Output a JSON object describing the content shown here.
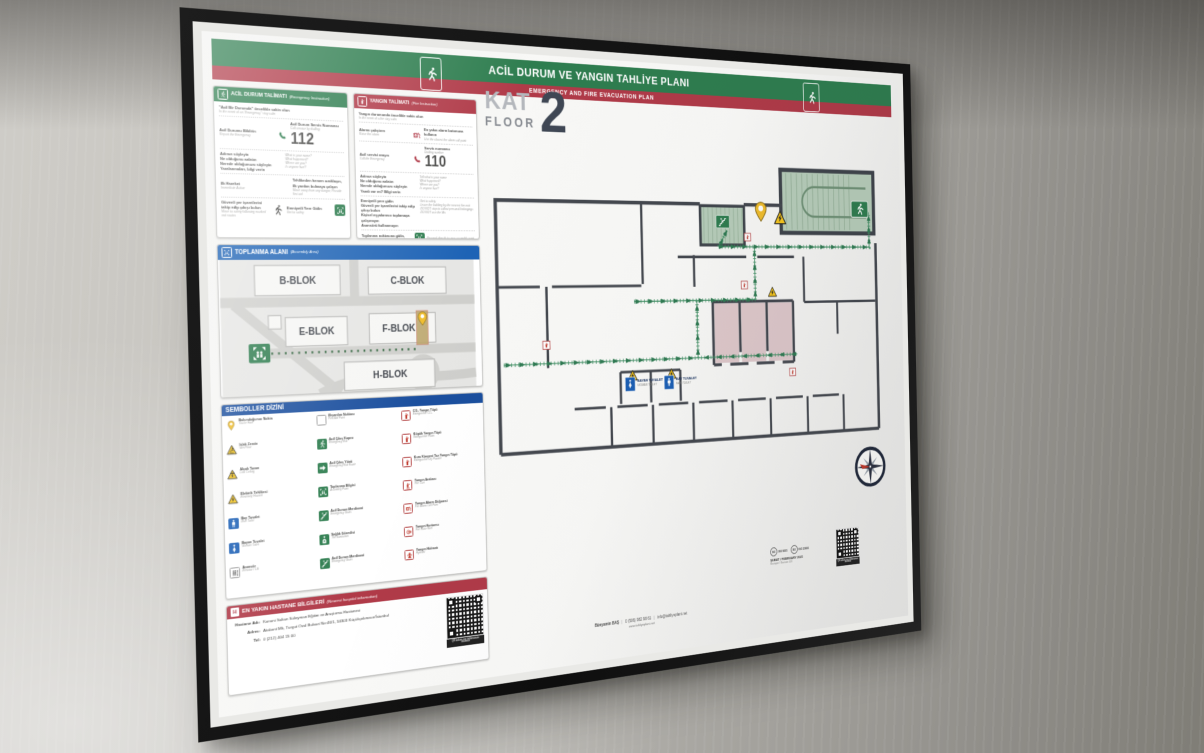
{
  "poster": {
    "header": {
      "title_tr": "ACİL DURUM VE YANGIN TAHLİYE PLANI",
      "title_en": "EMERGENCY AND FIRE EVACUATION PLAN"
    },
    "floor_badge": {
      "kat": "KAT",
      "floor": "FLOOR",
      "number": "2"
    },
    "emergency": {
      "title_tr": "ACİL DURUM TALİMATI",
      "title_en": "(Emergency Instruction)",
      "intro_tr": "\"Acil Bir Durumda\" öncelikle sakin olun",
      "intro_en": "In the event of an \"Emergency\" stay calm",
      "report_tr": "Acil Durumu Bildirin",
      "report_en": "Report the Emergency",
      "dial_tr": "Acil Durum Servis Numarası",
      "dial_en": "Call service by dialling",
      "number": "112",
      "steps_tr": [
        "Adınızı söyleyin",
        "Ne olduğunu anlatın",
        "Nerede olduğunuzu söyleyin",
        "Yaralanmaları, bilgi verin"
      ],
      "steps_en": [
        "What is your name?",
        "What happened?",
        "Where are you?",
        "Is anyone hurt?"
      ],
      "first_tr": "İlk Hareket",
      "first_en": "Immediate Action",
      "away_tr": "Tehlikeden hemen uzaklaşın, İlk yardım bulmaya çalışın",
      "away_en": "Move away from any danger, Provide first aid",
      "route_tr": "Güvenli yer işaretlerini takip edip çıkışı bulun",
      "route_en": "Move to safety following marked exit routes",
      "goto_tr": "Emniyetli Yere Gidin",
      "goto_en": "Get to safety"
    },
    "fire": {
      "title_tr": "YANGIN TALİMATI",
      "title_en": "(Fire Instruction)",
      "intro_tr": "Yangın durumunda öncelikle sakin olun",
      "intro_en": "In the event of a fire stay calm",
      "alarm_tr": "Alarmı çalıştırın",
      "alarm_en": "Raise the alarm",
      "alarm_use_tr": "En yakın alarm butonuna kullanın",
      "alarm_use_en": "Use the closest fire alarm call point",
      "call_tr": "Acil servisi arayın",
      "call_en": "Call the Emergency",
      "dial_tr": "Servis numarası",
      "dial_en": "Dialling number",
      "number": "110",
      "steps_tr": [
        "Adınızı söyleyin",
        "Ne olduğunu anlatın",
        "Nerede olduğunuzu söyleyin",
        "Yaralı var mı? Bilgi verin"
      ],
      "steps_en": [
        "Tell what is your name",
        "What happened?",
        "Where are you?",
        "Is anyone hurt?"
      ],
      "safety_tr": [
        "Emniyetli yere gidin",
        "Güvenli yer işaretlerini takip edip çıkışı bulun",
        "Kişisel eşyalarınızı toplamaya çalışmayın",
        "Asansörü kullanmayın"
      ],
      "safety_en": [
        "Get to safety",
        "Leave the building by the nearest fire exit",
        "DO NOT stop to collect personal belongings",
        "DO NOT use the lifts"
      ],
      "assembly_tr": "Toplanma noktasına gidin, Anons bilgisi verin",
      "assembly_en": "Proceed directly to your assembly point"
    },
    "assembly": {
      "title_tr": "TOPLANMA ALANI",
      "title_en": "(Assembly Area)",
      "blocks": [
        "B-BLOK",
        "C-BLOK",
        "E-BLOK",
        "F-BLOK",
        "H-BLOK"
      ]
    },
    "symbols": {
      "title": "SEMBOLLER DİZİNİ",
      "items": [
        {
          "icon": "location-pin",
          "tr": "Bulunduğunuz Nokta",
          "en": "You're Here"
        },
        {
          "icon": "wet-floor-warning",
          "tr": "Islak Zemin",
          "en": "Wet Floor"
        },
        {
          "icon": "low-ceiling-warning",
          "tr": "Alçak Tavan",
          "en": "Low Ceiling"
        },
        {
          "icon": "electricity-hazard-warning",
          "tr": "Elektrik Tehlikesi",
          "en": "Electricity Hazard"
        },
        {
          "icon": "man-toilet",
          "tr": "Bay Tuvalet",
          "en": "Man Toilet"
        },
        {
          "icon": "woman-toilet",
          "tr": "Bayan Tuvalet",
          "en": "Woman Toilet"
        },
        {
          "icon": "elevator",
          "tr": "Asansör",
          "en": "Elevator / Lift"
        },
        {
          "icon": "first-aid",
          "tr": "İlkyardım Noktası",
          "en": "First Aid Point"
        },
        {
          "icon": "emergency-exit-door",
          "tr": "Acil Çıkış Kapısı",
          "en": "Emergency Exit"
        },
        {
          "icon": "emergency-exit-route",
          "tr": "Acil Çıkış Yönü",
          "en": "Emergency Exit Route"
        },
        {
          "icon": "assembly-point",
          "tr": "Toplanma Bilgisi",
          "en": "Assembly Point"
        },
        {
          "icon": "emergency-stairs",
          "tr": "Acil Durum Merdiveni",
          "en": "Emergency Stairs"
        },
        {
          "icon": "sanitarian",
          "tr": "Sağlık Görevlisi",
          "en": "The Sanitarian"
        },
        {
          "icon": "emergency-stairs-down",
          "tr": "Acil Durum Merdiveni",
          "en": "Emergency Stairs"
        },
        {
          "icon": "extinguisher-co2",
          "tr": "CO₂ Yangın Tüpü",
          "en": "Extinguisher CO₂"
        },
        {
          "icon": "extinguisher-foam",
          "tr": "Köpük Yangın Tüpü",
          "en": "Extinguisher Foam"
        },
        {
          "icon": "extinguisher-dry-powder",
          "tr": "Kuru Kimyevi Toz Yangın Tüpü",
          "en": "Extinguisher Dry Powder"
        },
        {
          "icon": "fire-cart",
          "tr": "Yangın Arabası",
          "en": "Fire Cart"
        },
        {
          "icon": "fire-alarm-button",
          "tr": "Yangın Alarm Düğmesi",
          "en": "Fire Alarm Call Point"
        },
        {
          "icon": "fire-hose",
          "tr": "Yangın Hortumu",
          "en": "Fire Hose Reel"
        },
        {
          "icon": "fire-hydrant",
          "tr": "Yangın Hidrantı",
          "en": "Hydrant"
        }
      ]
    },
    "hospital": {
      "title_tr": "EN YAKIN HASTANE BİLGİLERİ",
      "title_en": "(Nearest hospital information)",
      "name_label": "Hastane Adı:",
      "name": "Kanuni Sultan Süleyman Eğitim ve Araştırma Hastanesi",
      "address_label": "Adres:",
      "address": "Atakent Mh, Turgut Özal Bulvari No:46/1, 34303 Küçükçekmece/İstanbul",
      "tel_label": "Tel:",
      "tel": "0 (212) 404 15 00"
    },
    "plan": {
      "toilet_woman_tr": "BAYAN TUVALET",
      "toilet_woman_en": "WOMAN TOILET",
      "toilet_man_tr": "BAY TUVALET",
      "toilet_man_en": "MAN TOILET"
    },
    "footer": {
      "author": "Bünyamin BAŞ",
      "phone": "0 (506) 982 98 61",
      "email": "info@tahliyeplani.net",
      "website": "www.tahliyeplani.net",
      "date": "ŞUBAT / FEBRUARY 2021",
      "revision": "Revizyon / Revision 001",
      "iso_1": "ISO 9001",
      "iso_2": "ISO 23601",
      "qr_caption": "QR kodunu cep telefonunuza okutunuz"
    },
    "colors": {
      "green": "#2e7d4f",
      "red": "#b03a48",
      "blue": "#1e63b5",
      "navy": "#1b4f9e",
      "route_green": "#3f8f63",
      "wall": "#44484f",
      "stair_fill": "#b7cdba",
      "room_pink": "#dcc3c6",
      "pin_yellow": "#f0bd2c"
    }
  }
}
